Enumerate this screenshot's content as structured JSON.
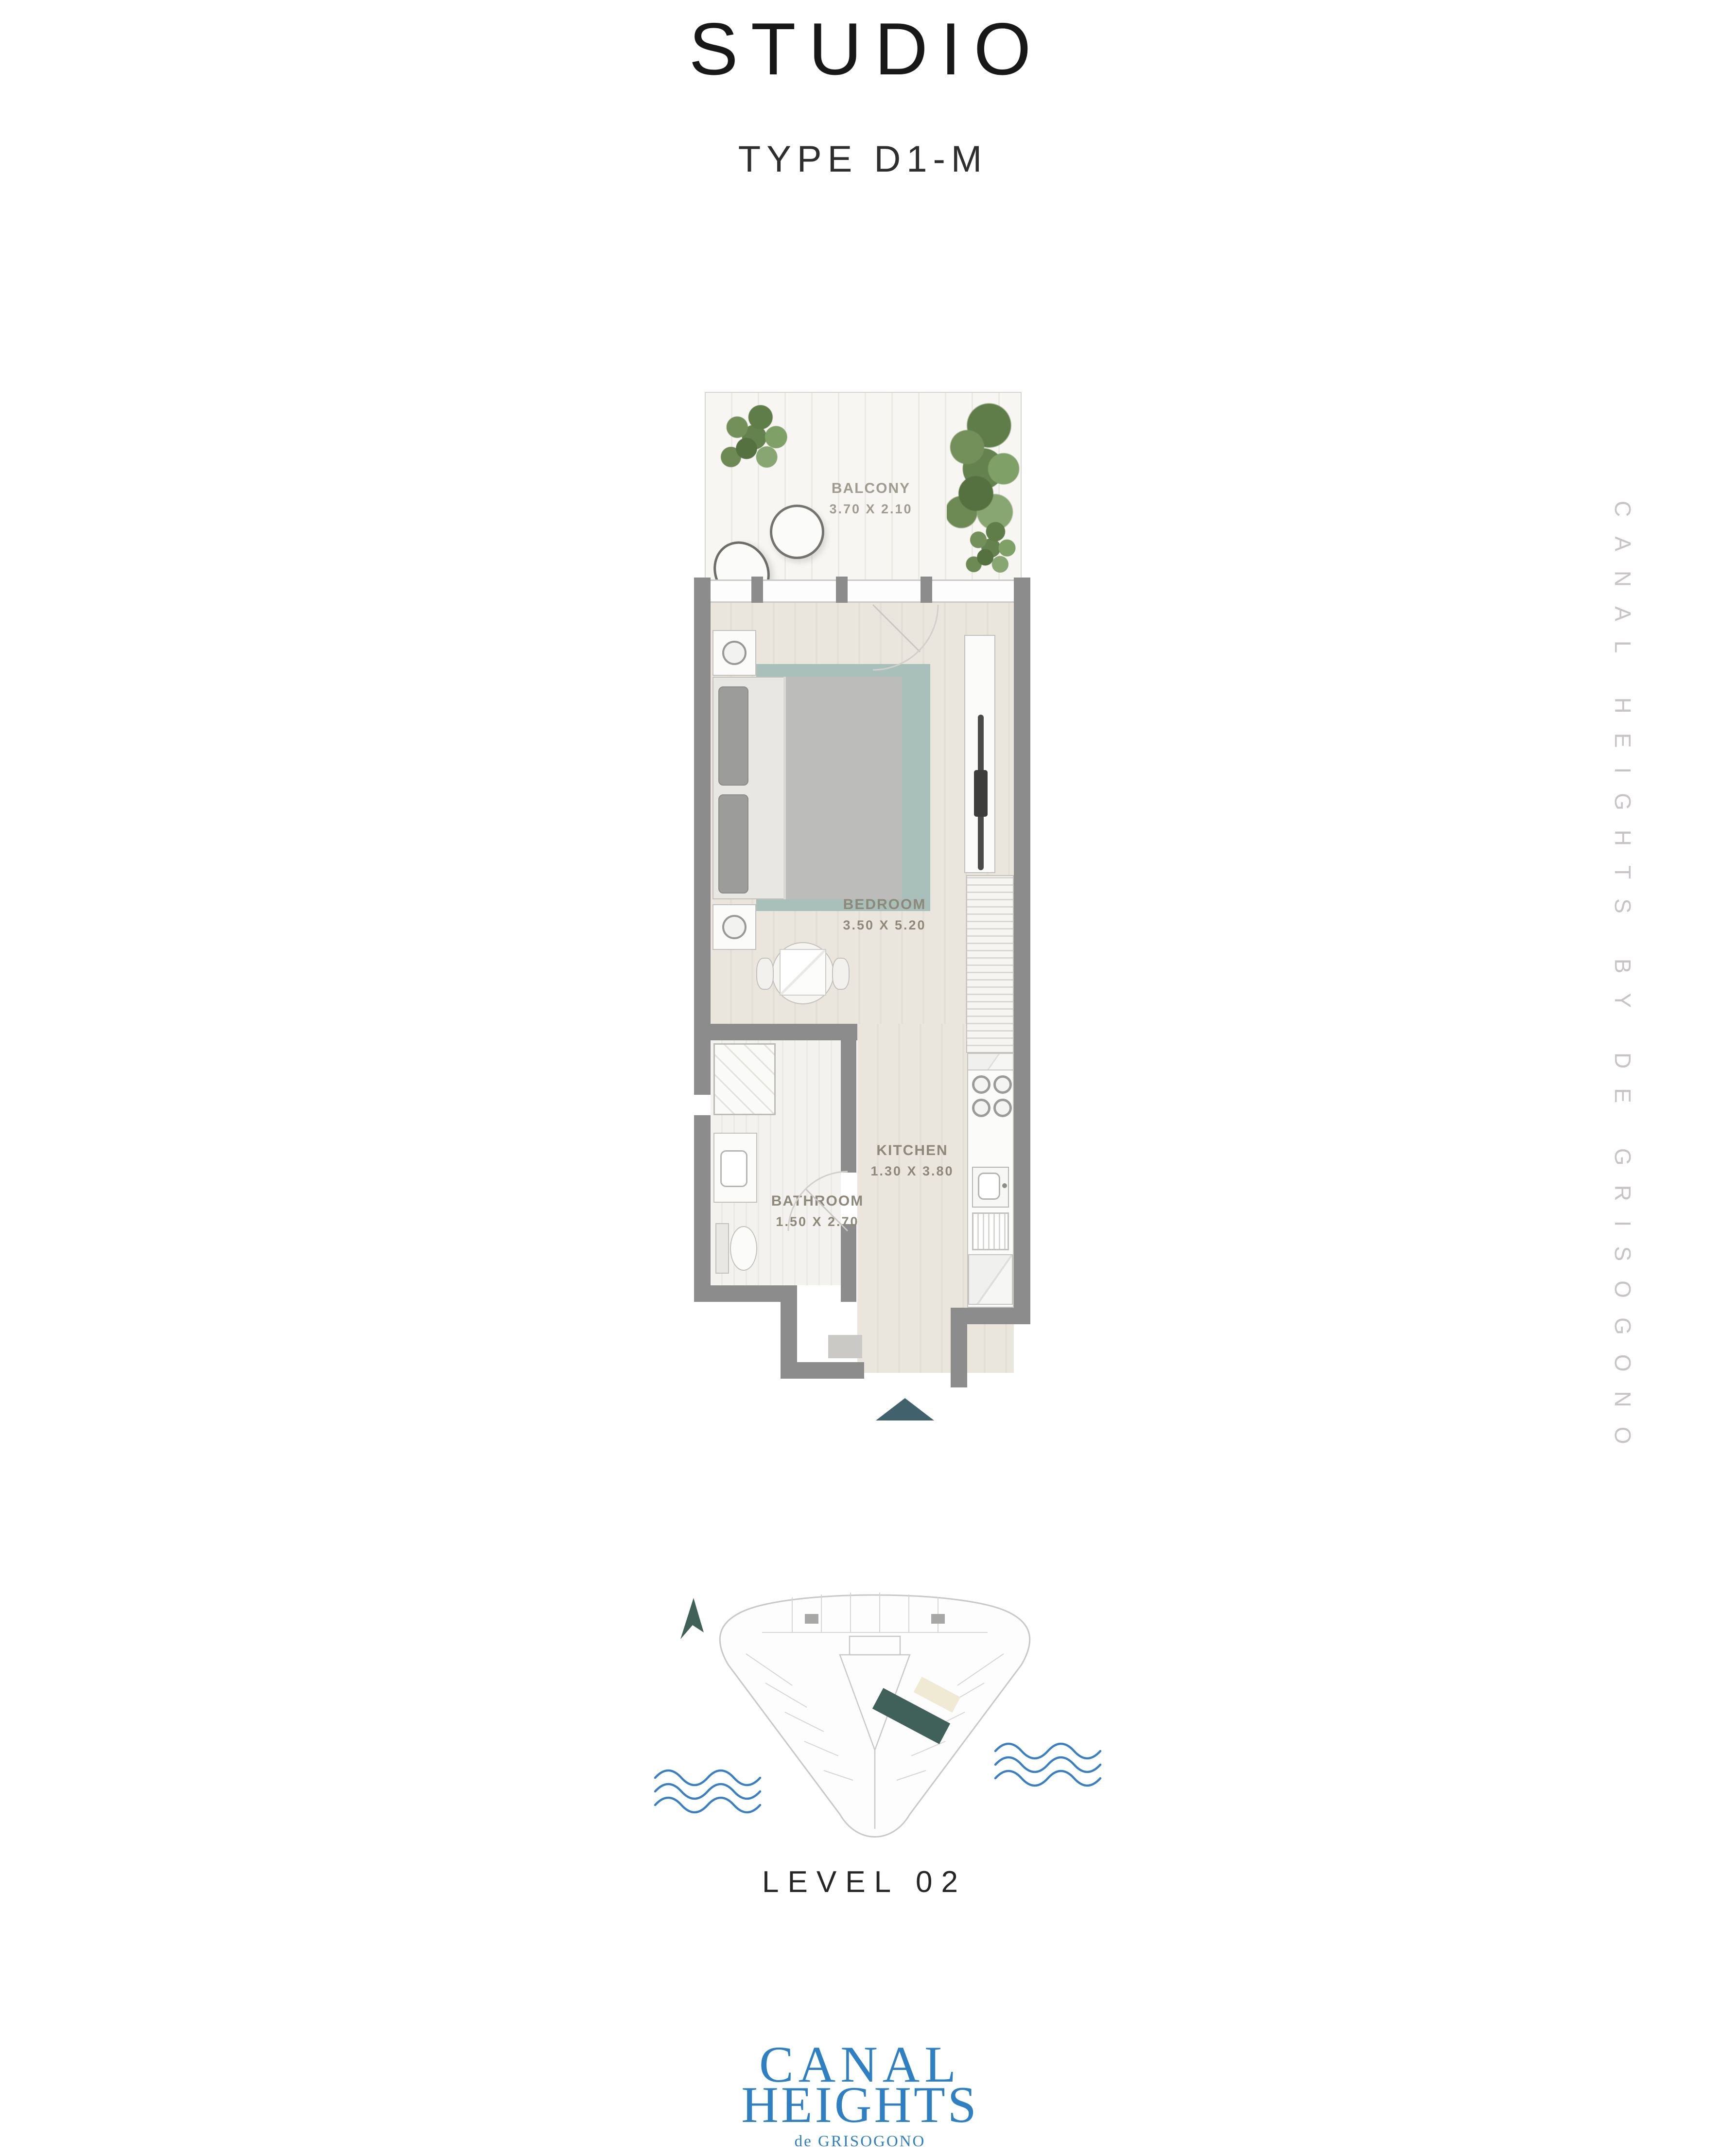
{
  "page": {
    "title": "STUDIO",
    "subtitle": "TYPE D1-M",
    "level_label": "LEVEL 02",
    "side_text": "CANAL HEIGHTS BY DE GRISOGONO"
  },
  "floor_plan": {
    "rooms": [
      {
        "name": "BALCONY",
        "dims": "3.70 X 2.10"
      },
      {
        "name": "BEDROOM",
        "dims": "3.50 X 5.20"
      },
      {
        "name": "KITCHEN",
        "dims": "1.30 X 3.80"
      },
      {
        "name": "BATHROOM",
        "dims": "1.50 X 2.70"
      }
    ],
    "entry_arrow_color": "#41626d",
    "wall_color": "#8c8c8c",
    "floor_color": "#eae6dd",
    "rug_color": "#a9bfba"
  },
  "key_plan": {
    "highlight_color": "#3f615a",
    "water_color": "#3a7fc2",
    "north_arrow_color": "#3f6157"
  },
  "branding": {
    "logo_line1": "CANAL",
    "logo_line2": "HEIGHTS",
    "logo_line3": "de GRISOGONO",
    "logo_color": "#2e80c3",
    "side_text_color": "#c7c3c7"
  }
}
